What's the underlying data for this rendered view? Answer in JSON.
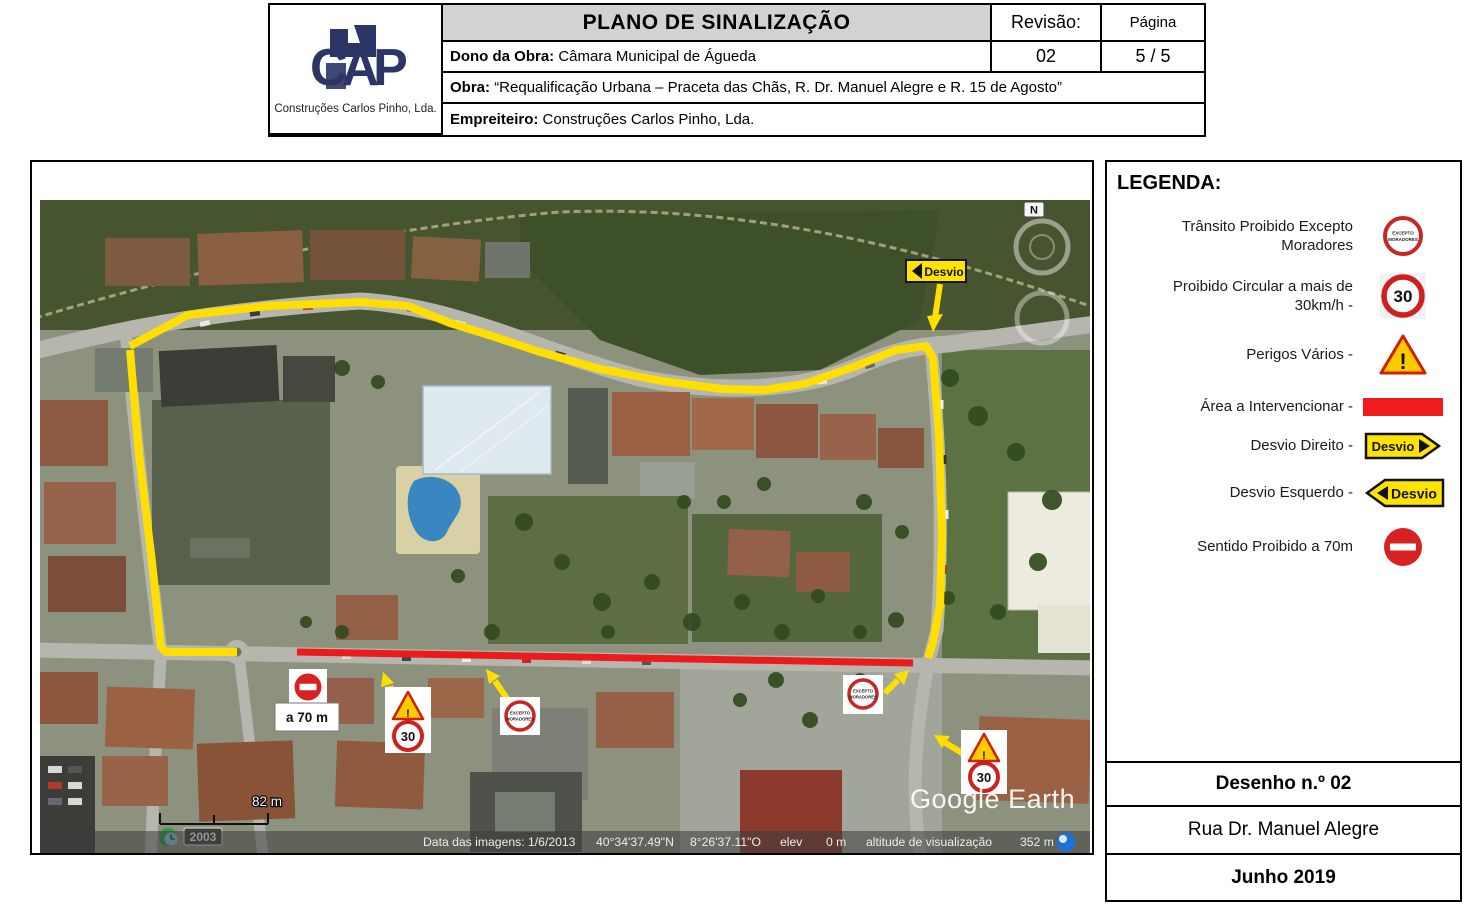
{
  "header": {
    "title": "PLANO DE SINALIZAÇÃO",
    "revisao_label": "Revisão:",
    "revisao_value": "02",
    "pagina_label": "Página",
    "pagina_value": "5 / 5",
    "dono_label": "Dono da Obra: ",
    "dono_value": "Câmara Municipal de Águeda",
    "obra_label": "Obra: ",
    "obra_value": "“Requalificação Urbana – Praceta das Chãs, R. Dr. Manuel Alegre e R. 15 de Agosto”",
    "empreiteiro_label": "Empreiteiro: ",
    "empreiteiro_value": "Construções Carlos Pinho, Lda.",
    "logo_text": "CAP",
    "company_name": "Construções Carlos Pinho, Lda."
  },
  "legend": {
    "title": "LEGENDA:",
    "items": [
      {
        "label": "Trânsito Proibido Excepto\nMoradores",
        "icon": "excepto-moradores-sign"
      },
      {
        "label": "Proibido Circular a mais de\n30km/h -",
        "icon": "speed-limit-30-sign"
      },
      {
        "label": "Perigos Vários -",
        "icon": "warning-sign"
      },
      {
        "label": "Área a Intervencionar -",
        "icon": "red-area"
      },
      {
        "label": "Desvio Direito -",
        "icon": "detour-right-sign"
      },
      {
        "label": "Desvio Esquerdo -",
        "icon": "detour-left-sign"
      },
      {
        "label": "Sentido Proibido a 70m",
        "icon": "no-entry-sign"
      }
    ]
  },
  "map": {
    "distance_label": "a 70 m",
    "scale_label": "82 m",
    "year_label": "2003",
    "watermark": "Google Earth",
    "compass_n": "N",
    "signs": {
      "desvio_label": "Desvio",
      "speed_value": "30",
      "warning_mark": "!",
      "excepto_line1": "EXCEPTO",
      "excepto_line2": "MORADORES"
    },
    "status_bar": {
      "date": "Data das imagens: 1/6/2013",
      "latitude": "40°34'37.49\"N",
      "longitude": "8°26'37.11\"O",
      "elev_label": "elev",
      "elev_value": "0 m",
      "alt_label": "altitude de visualização",
      "alt_value": "352 m"
    }
  },
  "footer": {
    "desenho": "Desenho n.º 02",
    "rua": "Rua Dr. Manuel Alegre",
    "data": "Junho 2019"
  },
  "colors": {
    "route_yellow": "#ffdf00",
    "area_red": "#ec1b1b",
    "sign_red": "#cf2020",
    "logo_navy": "#2b3566"
  }
}
